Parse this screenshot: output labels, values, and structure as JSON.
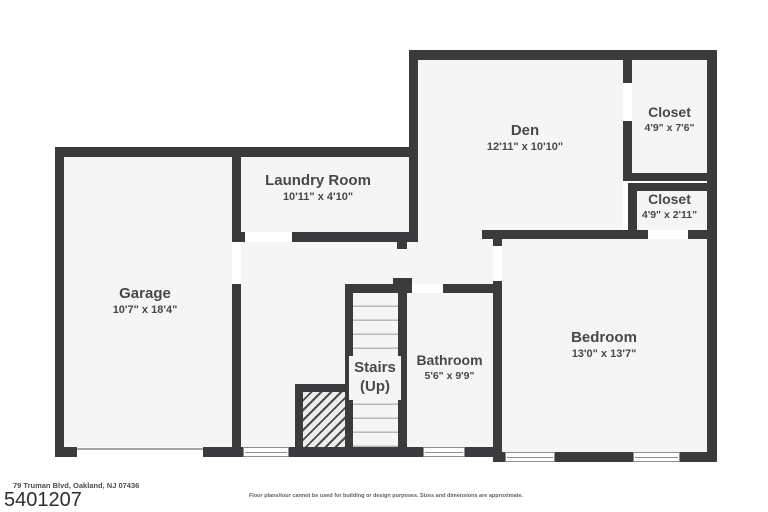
{
  "rooms": {
    "garage": {
      "name": "Garage",
      "dims": "10'7\" x 18'4\""
    },
    "laundry": {
      "name": "Laundry Room",
      "dims": "10'11\" x 4'10\""
    },
    "den": {
      "name": "Den",
      "dims": "12'11\" x 10'10\""
    },
    "closet_upper": {
      "name": "Closet",
      "dims": "4'9\" x 7'6\""
    },
    "closet_lower": {
      "name": "Closet",
      "dims": "4'9\" x 2'11\""
    },
    "bedroom": {
      "name": "Bedroom",
      "dims": "13'0\" x 13'7\""
    },
    "bathroom": {
      "name": "Bathroom",
      "dims": "5'6\" x 9'9\""
    },
    "stairs": {
      "name": "Stairs",
      "direction": "(Up)"
    }
  },
  "footer": {
    "address": "79 Truman Blvd, Oakland, NJ 07436",
    "listing_number": "5401207",
    "disclaimer": "Floor plans/tour cannot be used for building or design purposes. Sizes and dimensions are approximate."
  },
  "colors": {
    "wall": "#3b3b3e",
    "floor": "#f5f5f5",
    "background": "#ffffff"
  }
}
